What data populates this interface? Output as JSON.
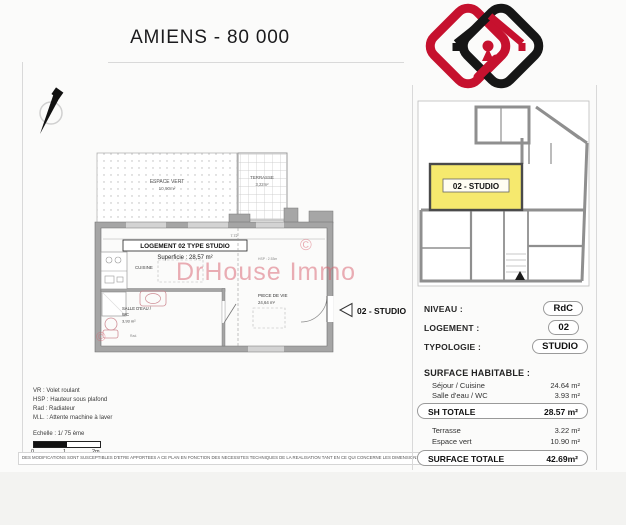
{
  "page": {
    "title": "AMIENS - 80 000"
  },
  "logo": {
    "name": "DrHouse Immo",
    "red": "#c6112e",
    "black": "#161616"
  },
  "plan": {
    "espace_vert_label": "ESPACE VERT",
    "espace_vert_area": "10,90m²",
    "terrasse_label": "TERRASSE",
    "terrasse_area": "3,22m²",
    "logement_box": "LOGEMENT 02 TYPE STUDIO",
    "superficie": "Superficie : 28,57 m²",
    "cuisine": "CUISINE",
    "salle_eau_line1": "SALLE D'EAU /",
    "salle_eau_line2": "WC",
    "salle_eau_area": "3,93 m²",
    "piece_vie": "PIECE DE VIE",
    "piece_vie_area": "24,64 m²",
    "hsp_note": "HSP : 2.53m",
    "rad_note": "Rad.",
    "dim_top": "7.72",
    "unit_tag": "02 - STUDIO",
    "watermark": "DrHouse Immo",
    "copyright": "©"
  },
  "legend": {
    "lines": [
      "VR : Volet roulant",
      "HSP : Hauteur sous plafond",
      "Rad : Radiateur",
      "M.L. : Attente machine à laver"
    ],
    "scale_label": "Echelle : 1/ 75 ème",
    "scale_ticks": [
      "0",
      "1",
      "2m"
    ]
  },
  "disclaimer": "DES MODIFICATIONS SONT SUSCEPTIBLES D'ETRE APPORTEES A CE PLAN EN FONCTION DES NECESSITES TECHNIQUES DE LA REALISATION TANT EN CE QUI CONCERNE LES DIMENSIONS LIBRES QUE LES EQUIPEMENTS.",
  "panel": {
    "mini_plan_tag": "02 - STUDIO",
    "highlight_color": "#f6e96e",
    "rows": [
      {
        "label": "NIVEAU :",
        "value": "RdC"
      },
      {
        "label": "LOGEMENT :",
        "value": "02"
      },
      {
        "label": "TYPOLOGIE :",
        "value": "STUDIO"
      }
    ],
    "surface_heading": "SURFACE HABITABLE :",
    "surface_rows": [
      {
        "label": "Séjour / Cuisine",
        "value": "24.64 m²"
      },
      {
        "label": "Salle d'eau / WC",
        "value": "3.93 m²"
      }
    ],
    "sh_totale": {
      "label": "SH TOTALE",
      "value": "28.57 m²"
    },
    "extra_rows": [
      {
        "label": "Terrasse",
        "value": "3.22 m²"
      },
      {
        "label": "Espace vert",
        "value": "10.90 m²"
      }
    ],
    "surface_totale": {
      "label": "SURFACE TOTALE",
      "value": "42.69m²"
    }
  }
}
